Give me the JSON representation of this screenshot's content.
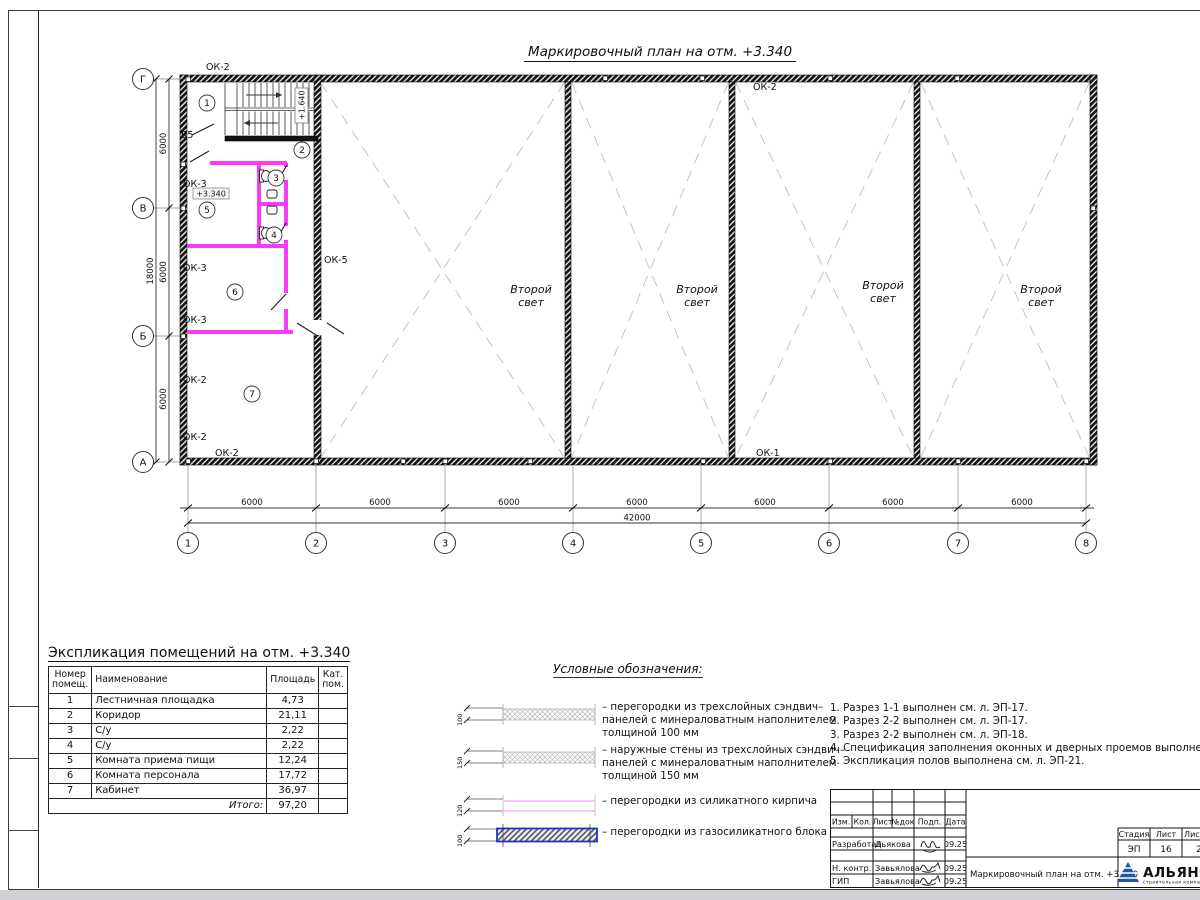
{
  "sheet": {
    "plan_title": "Маркировочный план на отм. +3.340",
    "colors": {
      "partition_magenta": "#f73bf7",
      "logo_blue": "#1e56a8",
      "legend_block_border": "#2233cc"
    }
  },
  "plan": {
    "axes_v": [
      "Г",
      "В",
      "Б",
      "А"
    ],
    "axes_h": [
      "1",
      "2",
      "3",
      "4",
      "5",
      "6",
      "7",
      "8"
    ],
    "dims_bottom": [
      "6000",
      "6000",
      "6000",
      "6000",
      "6000",
      "6000",
      "6000"
    ],
    "dim_total_bottom": "42000",
    "dims_left": [
      "6000",
      "6000",
      "6000"
    ],
    "dim_total_left": "18000",
    "window_labels": [
      "ОК-2",
      "ОК-2",
      "ОК-3",
      "ОК-3",
      "ОК-3",
      "ОК-2",
      "ОК-2",
      "ОК-2",
      "ОК-5",
      "ОК-1"
    ],
    "door_label": "Д5",
    "elevation_main": "+3.340",
    "elevation_stair": "+1.640",
    "rooms": [
      "1",
      "2",
      "3",
      "4",
      "5",
      "6",
      "7"
    ],
    "second_light": {
      "l1": "Второй",
      "l2": "свет"
    }
  },
  "exploitation": {
    "title": "Экспликация помещений на отм. +3.340",
    "headers": {
      "num": "Номер помещ.",
      "name": "Наименование",
      "area": "Площадь",
      "cat": "Кат. пом."
    },
    "rows": [
      {
        "num": "1",
        "name": "Лестничная площадка",
        "area": "4,73"
      },
      {
        "num": "2",
        "name": "Коридор",
        "area": "21,11"
      },
      {
        "num": "3",
        "name": "С/у",
        "area": "2,22"
      },
      {
        "num": "4",
        "name": "С/у",
        "area": "2,22"
      },
      {
        "num": "5",
        "name": "Комната приема пищи",
        "area": "12,24"
      },
      {
        "num": "6",
        "name": "Комната персонала",
        "area": "17,72"
      },
      {
        "num": "7",
        "name": "Кабинет",
        "area": "36,97"
      }
    ],
    "total_label": "Итого:",
    "total_value": "97,20"
  },
  "legend": {
    "title": "Условные обозначения:",
    "items": [
      {
        "dim": "100",
        "text": "– перегородки из трехслойных сэндвич–панелей с минераловатным наполнителем толщиной 100 мм"
      },
      {
        "dim": "150",
        "text": "– наружные стены из трехслойных сэндвич–панелей с минераловатным наполнителем толщиной 150 мм"
      },
      {
        "dim": "120",
        "text": "– перегородки из силикатного кирпича"
      },
      {
        "dim": "100",
        "text": "– перегородки из газосиликатного блока"
      }
    ]
  },
  "notes": [
    "1. Разрез 1-1 выполнен см. л. ЭП-17.",
    "2. Разрез 2-2 выполнен см. л. ЭП-17.",
    "3. Разрез 2-2 выполнен см. л. ЭП-18.",
    "4. Спецификация заполнения оконных и дверных проемов выполнена см. л. ЭП-20.",
    "5. Экспликация полов выполнена см. л. ЭП-21."
  ],
  "titleblock": {
    "headers": [
      "Изм.",
      "Кол.",
      "Лист",
      "№док",
      "Подп.",
      "Дата"
    ],
    "sig_rows": [
      {
        "role": "Разработал",
        "name": "Дьякова",
        "date": "09.25"
      },
      {
        "role": "Н. контр.",
        "name": "Завьялова",
        "date": "09.25"
      },
      {
        "role": "ГИП",
        "name": "Завьялова",
        "date": "09.25"
      }
    ],
    "doc_title": "Маркировочный план на отм. +3.340",
    "stage": {
      "headers": [
        "Стадия",
        "Лист",
        "Листов"
      ],
      "values": [
        "ЭП",
        "16",
        "2"
      ]
    },
    "logo": {
      "name": "АЛЬЯНС",
      "tagline": "строительная компания"
    }
  }
}
